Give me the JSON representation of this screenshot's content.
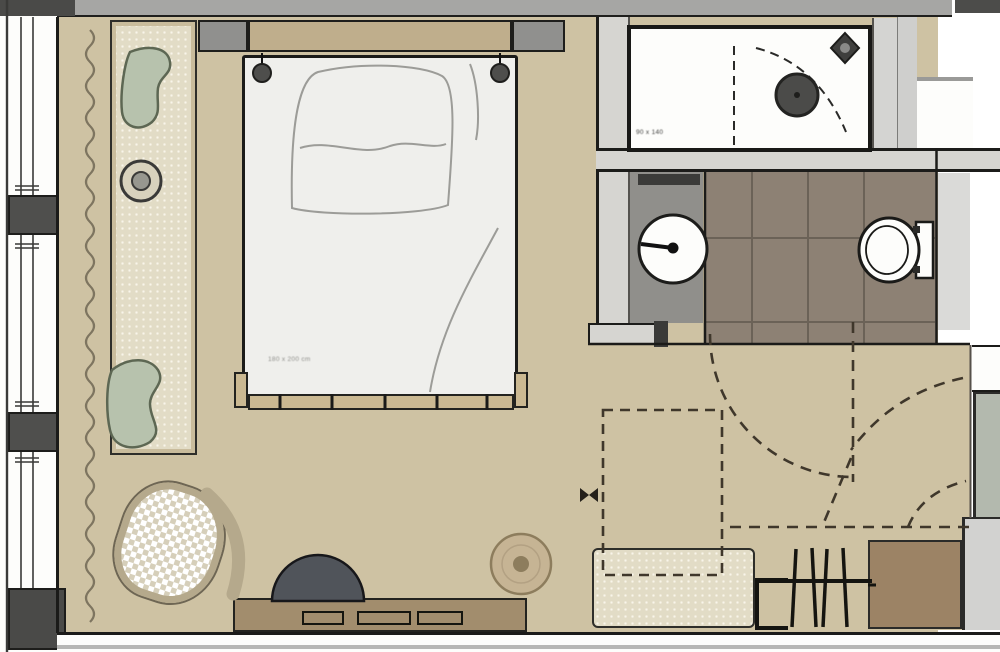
{
  "labels": {
    "bed_size": "180 x 200 cm",
    "shower_size": "90 x 140"
  },
  "colors": {
    "wall_gray": "#a6a6a4",
    "wall_dark": "#4a4a48",
    "carpet_tan": "#cec2a3",
    "tile_brown": "#8d8174",
    "wall_light": "#d6d5d1",
    "headboard_tan": "#bfae8c",
    "furniture_brown": "#a28d6d",
    "cabinet_brown": "#9c8365",
    "cushion_green": "#b7c2ad",
    "bench_cream": "#e2dcc6",
    "chair_dark": "#50545a",
    "pouf_tan": "#c6b494",
    "outline_black": "#1b1b19"
  }
}
